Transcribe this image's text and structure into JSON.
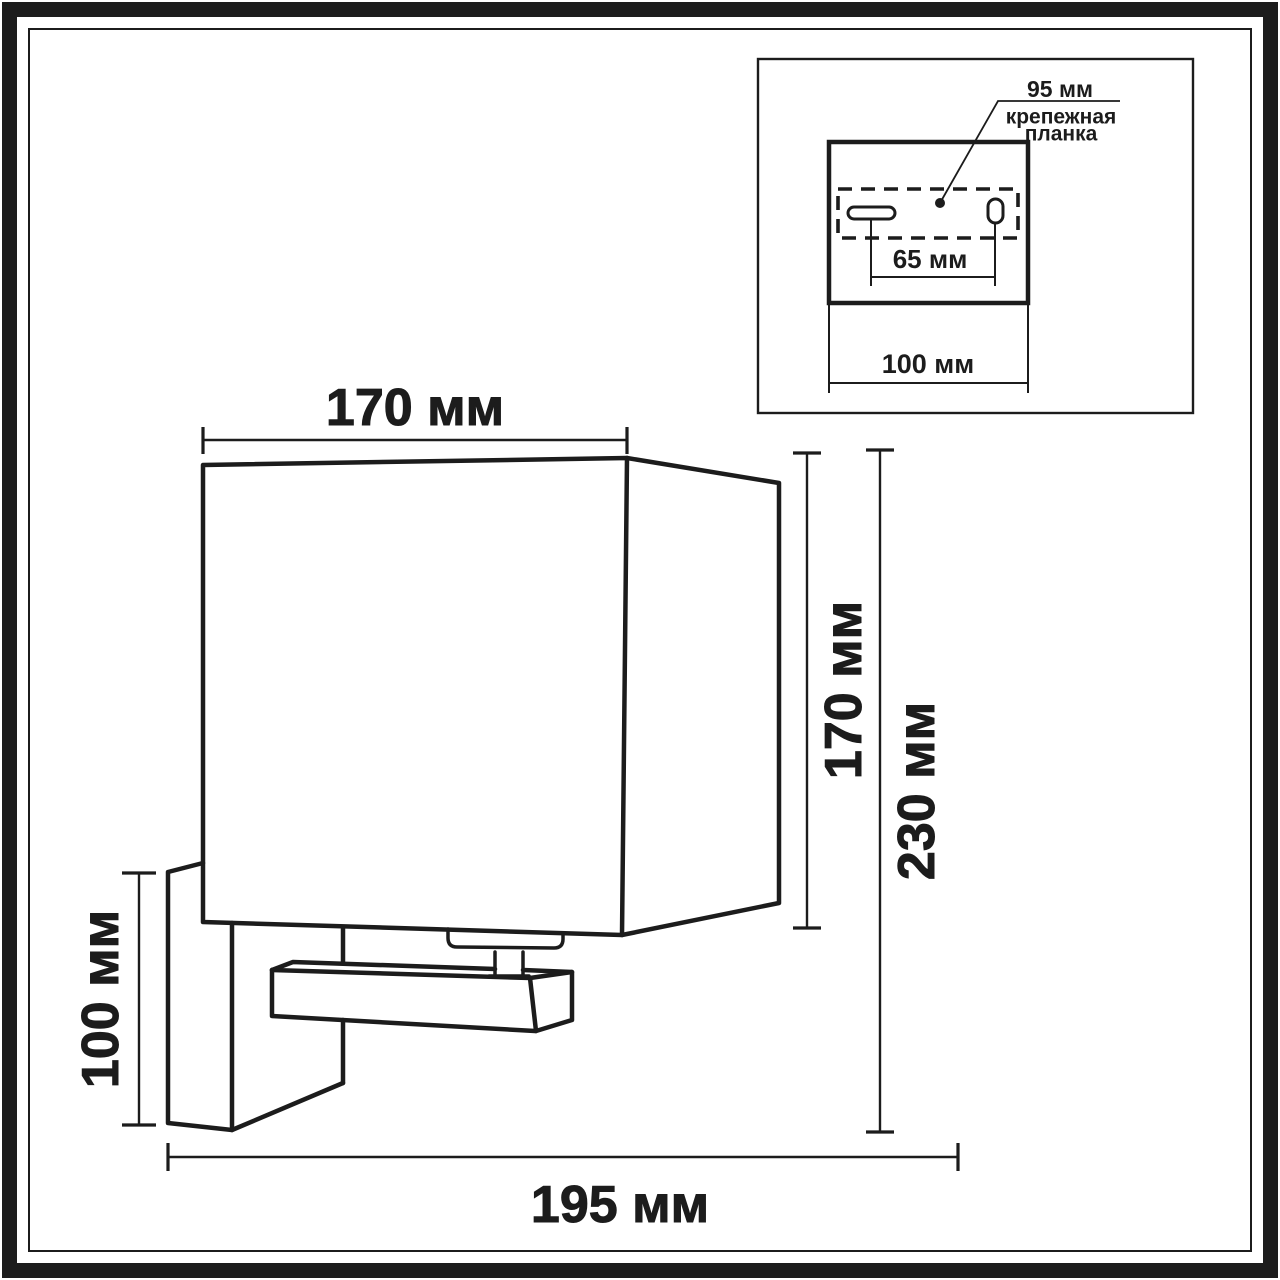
{
  "drawing": {
    "dimensions": {
      "shade_width": "170 мм",
      "shade_height": "170 мм",
      "total_height": "230 мм",
      "backplate_height": "100 мм",
      "total_depth": "195 мм"
    }
  },
  "inset": {
    "plate_width": "95 мм",
    "plate_label_line1": "крепежная",
    "plate_label_line2": "планка",
    "hole_spacing": "65 мм",
    "box_width": "100 мм"
  },
  "colors": {
    "line": "#1c1c1c",
    "background": "#ffffff"
  }
}
